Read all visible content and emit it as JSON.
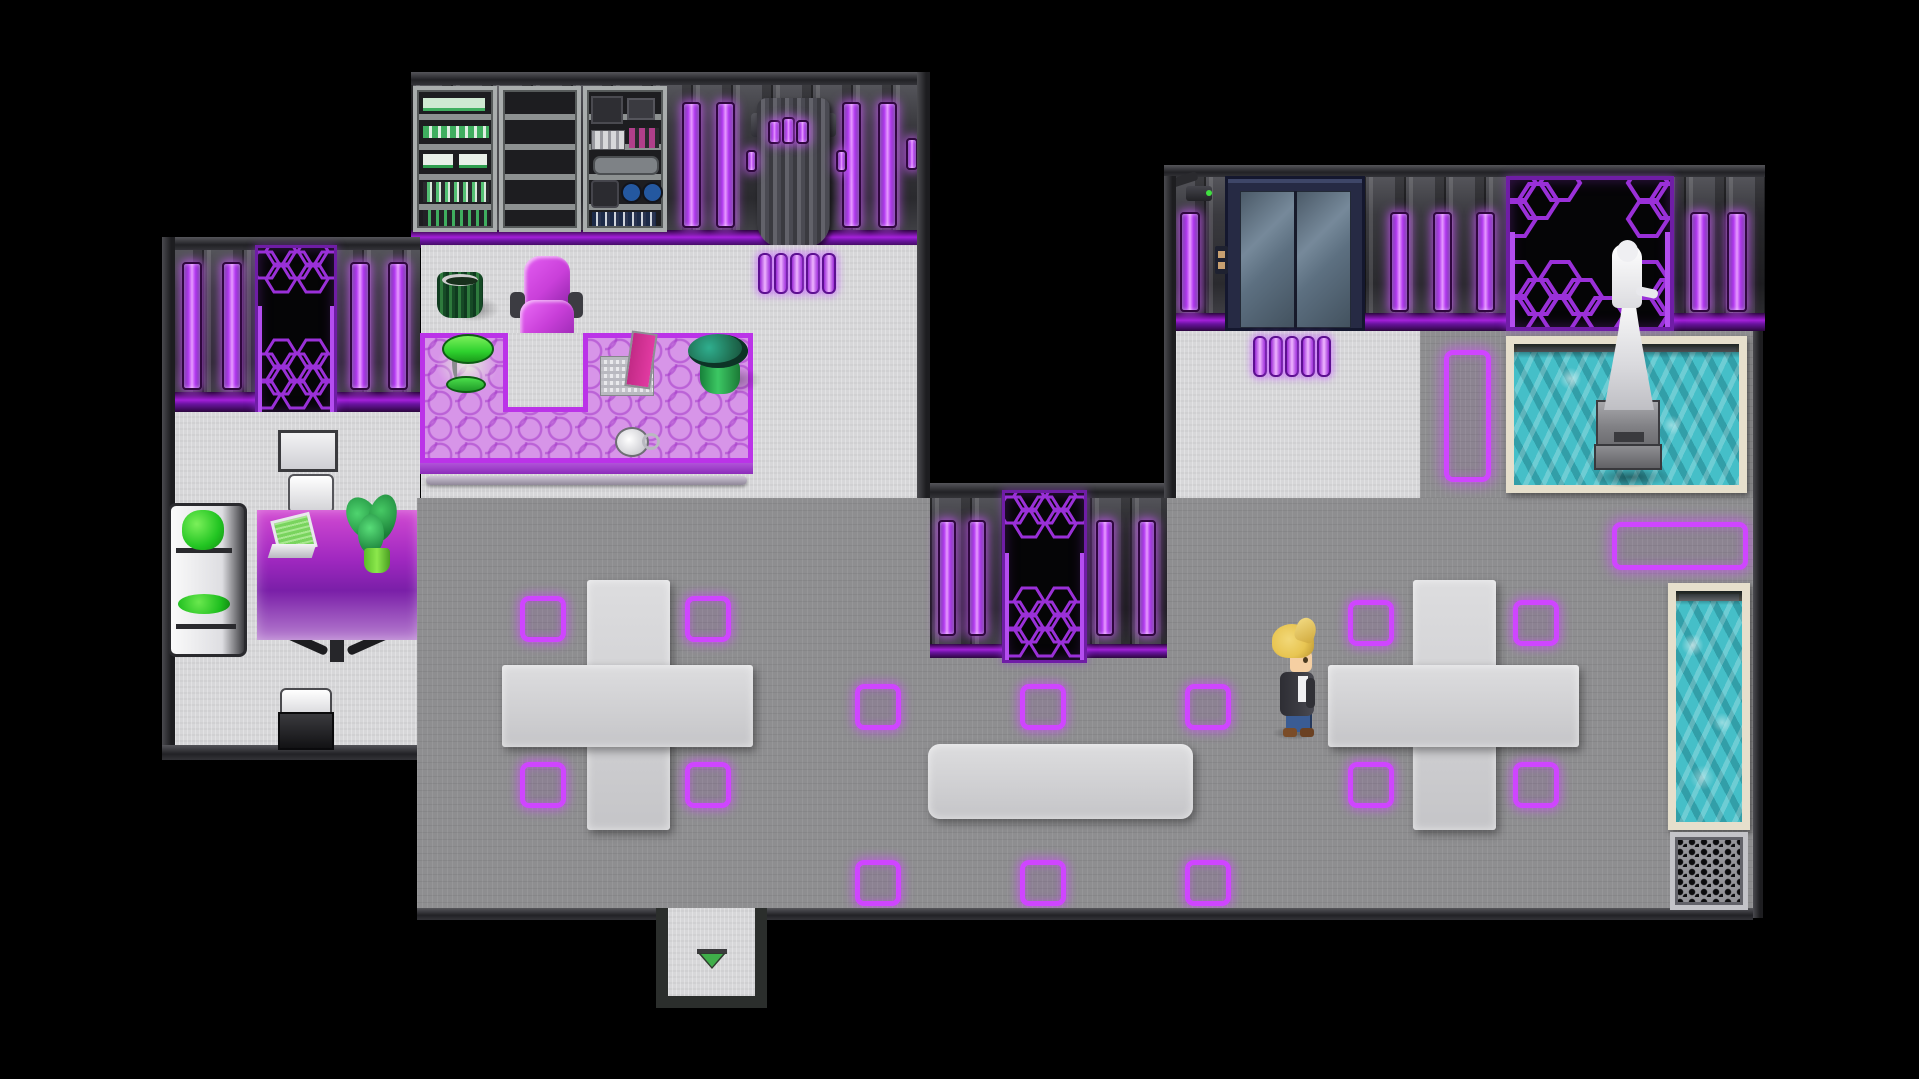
{
  "viewport": {
    "width": 1919,
    "height": 1079
  },
  "game": {
    "style": "top-down sci-fi interior map, RPG-Maker-like",
    "player": {
      "label": "player-character",
      "facing": "right",
      "hair": "blonde pompadour",
      "outfit": "dark jacket, white shirt, blue jeans, brown shoes"
    },
    "rooms": [
      {
        "name": "server-office",
        "objects": [
          "server-rack-green-modules",
          "server-rack-empty",
          "server-rack-equipment",
          "wall-drape-banner",
          "purple-light-strip",
          "green-trash-bin",
          "magenta-office-chair",
          "hex-glass-desk",
          "green-desk-lamp",
          "laptop",
          "potted-plant",
          "coffee-cup",
          "floor-light-pills"
        ]
      },
      {
        "name": "lounge-room",
        "objects": [
          "hex-panel-door",
          "white-desk",
          "white-stool",
          "white-sofa-green-cushions",
          "purple-glass-desk",
          "laptop-green-screen",
          "potted-plant",
          "white-stool",
          "black-terminal-desk"
        ]
      },
      {
        "name": "elevator-hall",
        "objects": [
          "security-camera",
          "elevator",
          "elevator-call-panel",
          "statue-alcove-hex",
          "white-robed-statue",
          "statue-pedestal",
          "fountain-pool",
          "floor-light-pills",
          "vertical-glow-rectangle"
        ]
      },
      {
        "name": "main-hall",
        "objects": [
          "hex-panel-door",
          "cross-platform-left",
          "cross-platform-right",
          "bench-platform",
          "glow-floor-markers",
          "horizontal-glow-rectangle",
          "wall-pool",
          "floor-grate",
          "exit-alcove"
        ]
      }
    ],
    "counts": {
      "glow_floor_markers": 14,
      "office_floor_pills": 5,
      "elevator_floor_pills": 5
    },
    "exit_indicator": "green-down-arrow"
  },
  "colors": {
    "bg": "#000000",
    "glow": "#cf45ff",
    "barCore": "#e79bff",
    "barMid": "#b53cf2",
    "barEdge": "#6d1fa4",
    "stripeBright": "#a31fd9",
    "hexLine": "#9a30d8",
    "doorBlack": "#050506",
    "floorWhite": "#d7d7d9",
    "floorGray": "#8e8e90",
    "water": "#45bfc8",
    "poolFrame": "#e6dfcc",
    "deskTop": "#d795e8",
    "deskBorder": "#bb33e8",
    "green": "#2ed12e",
    "leaf": "#1f6f52",
    "chairMagenta": "#c93fd9",
    "elevatorFrame": "#262a44",
    "skin": "#f5cfa2",
    "hair": "#e8c552",
    "jeans": "#3a5c94",
    "jacket": "#3b3b42",
    "arrowGreen": "#3fae4a"
  }
}
